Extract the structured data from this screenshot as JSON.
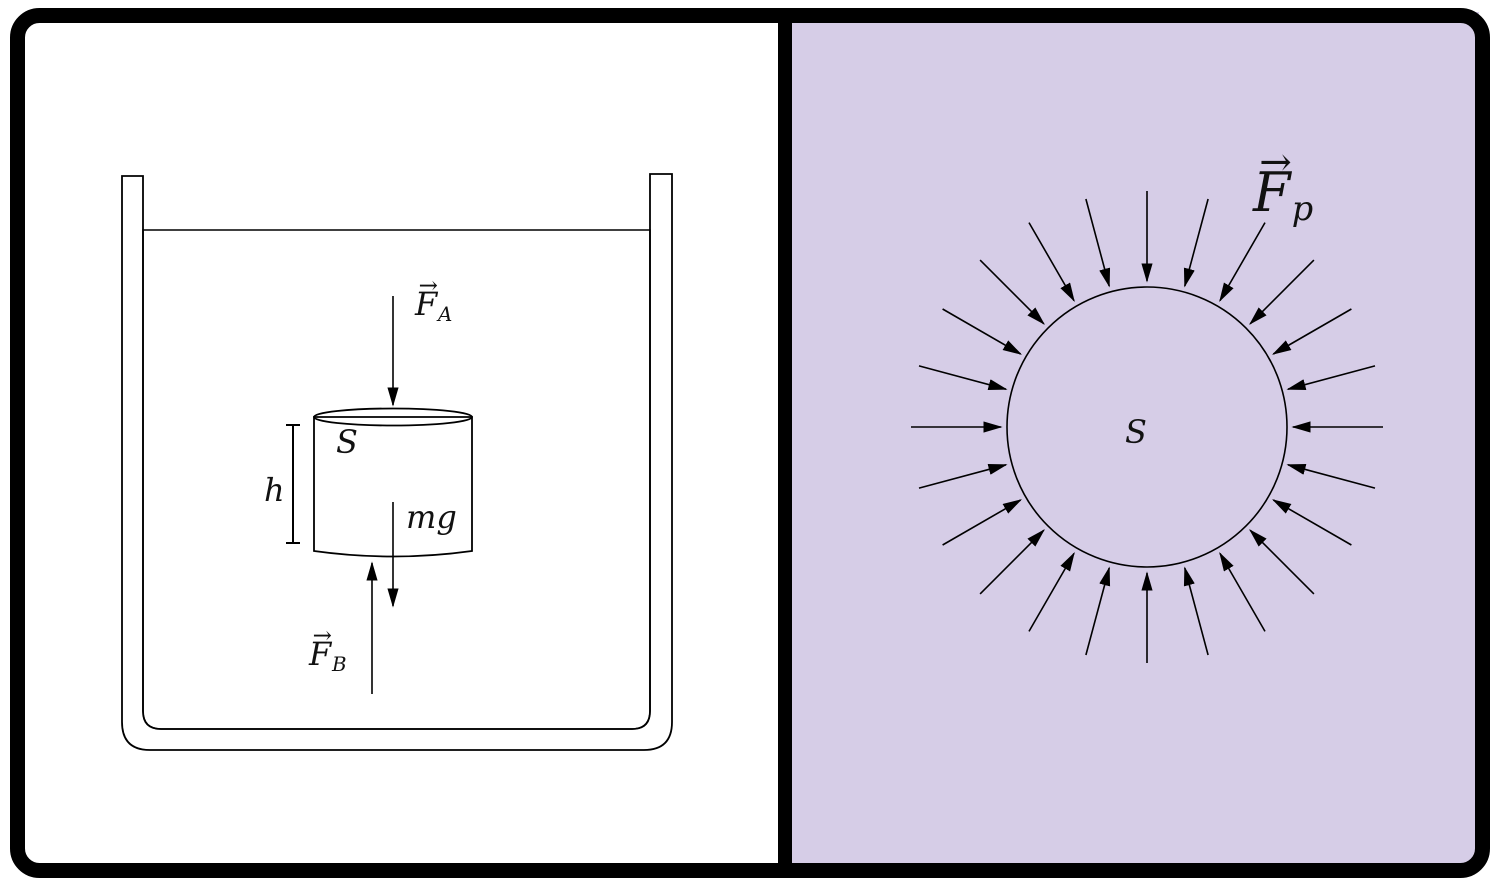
{
  "figure": {
    "kind": "buoyancy-pressure-diagram",
    "panel_count": 2
  },
  "colors": {
    "liquid": "#d6cde7",
    "line": "#000000",
    "panel_background": "#ffffff",
    "frame": "#000000"
  },
  "left_panel": {
    "labels": {
      "applied_force": {
        "vector_mark": "→",
        "base": "F",
        "sub": "A"
      },
      "top_surface": "S",
      "height": "h",
      "weight": "mg",
      "buoyant_force": {
        "vector_mark": "→",
        "base": "F",
        "sub": "B"
      }
    }
  },
  "right_panel": {
    "labels": {
      "surface": "S",
      "pressure_force": {
        "vector_mark": "→",
        "base": "F",
        "sub": "p"
      }
    },
    "pressure_arrows": {
      "count": 24,
      "angle_step_deg": 15,
      "tail_radius": 236,
      "tip_radius": 146,
      "center_x": 1147,
      "center_y": 427,
      "circle_radius": 140
    }
  }
}
